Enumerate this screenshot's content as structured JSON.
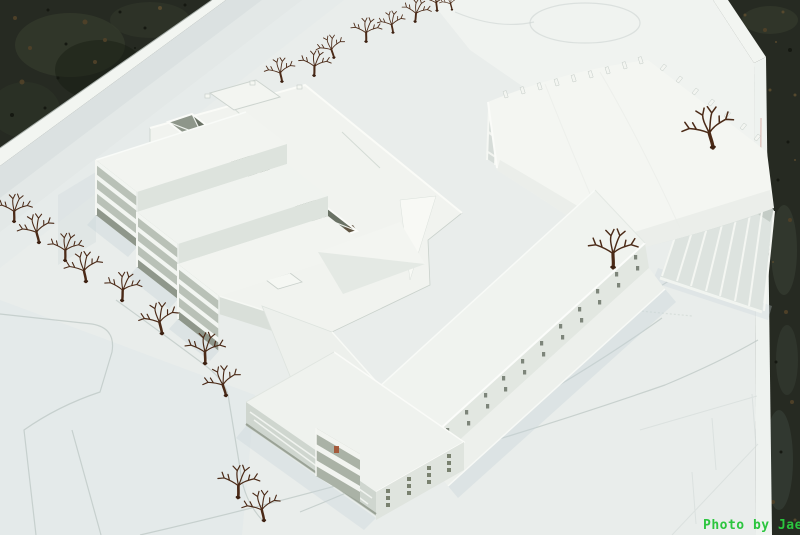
{
  "watermark": {
    "text": "Photo by Jae",
    "color": "#2bc53e"
  },
  "scene": {
    "description": "Aerial photograph of a white architectural scale model on a white baseboard over dark concrete: terraced courtyard building at left with three skylight wells, a long diagonal bar wing, a vaulted-roof hall at right with a colonnade, and bare wire trees along paths.",
    "palette": {
      "concrete_ground": "#262a22",
      "baseboard": "#e9edeb",
      "board_edge": "#f2f5f1",
      "building_white": "#f3f5f1",
      "building_shade": "#dde3dd",
      "courtyard_recess": "#8e968a",
      "tan_accent": "#cbbf9e",
      "red_accent": "#a34a28",
      "tree_brown": "#4b2a17",
      "path_lines": "#bdc7c4",
      "watermark_green": "#2bc53e"
    },
    "tree_count": 20
  }
}
